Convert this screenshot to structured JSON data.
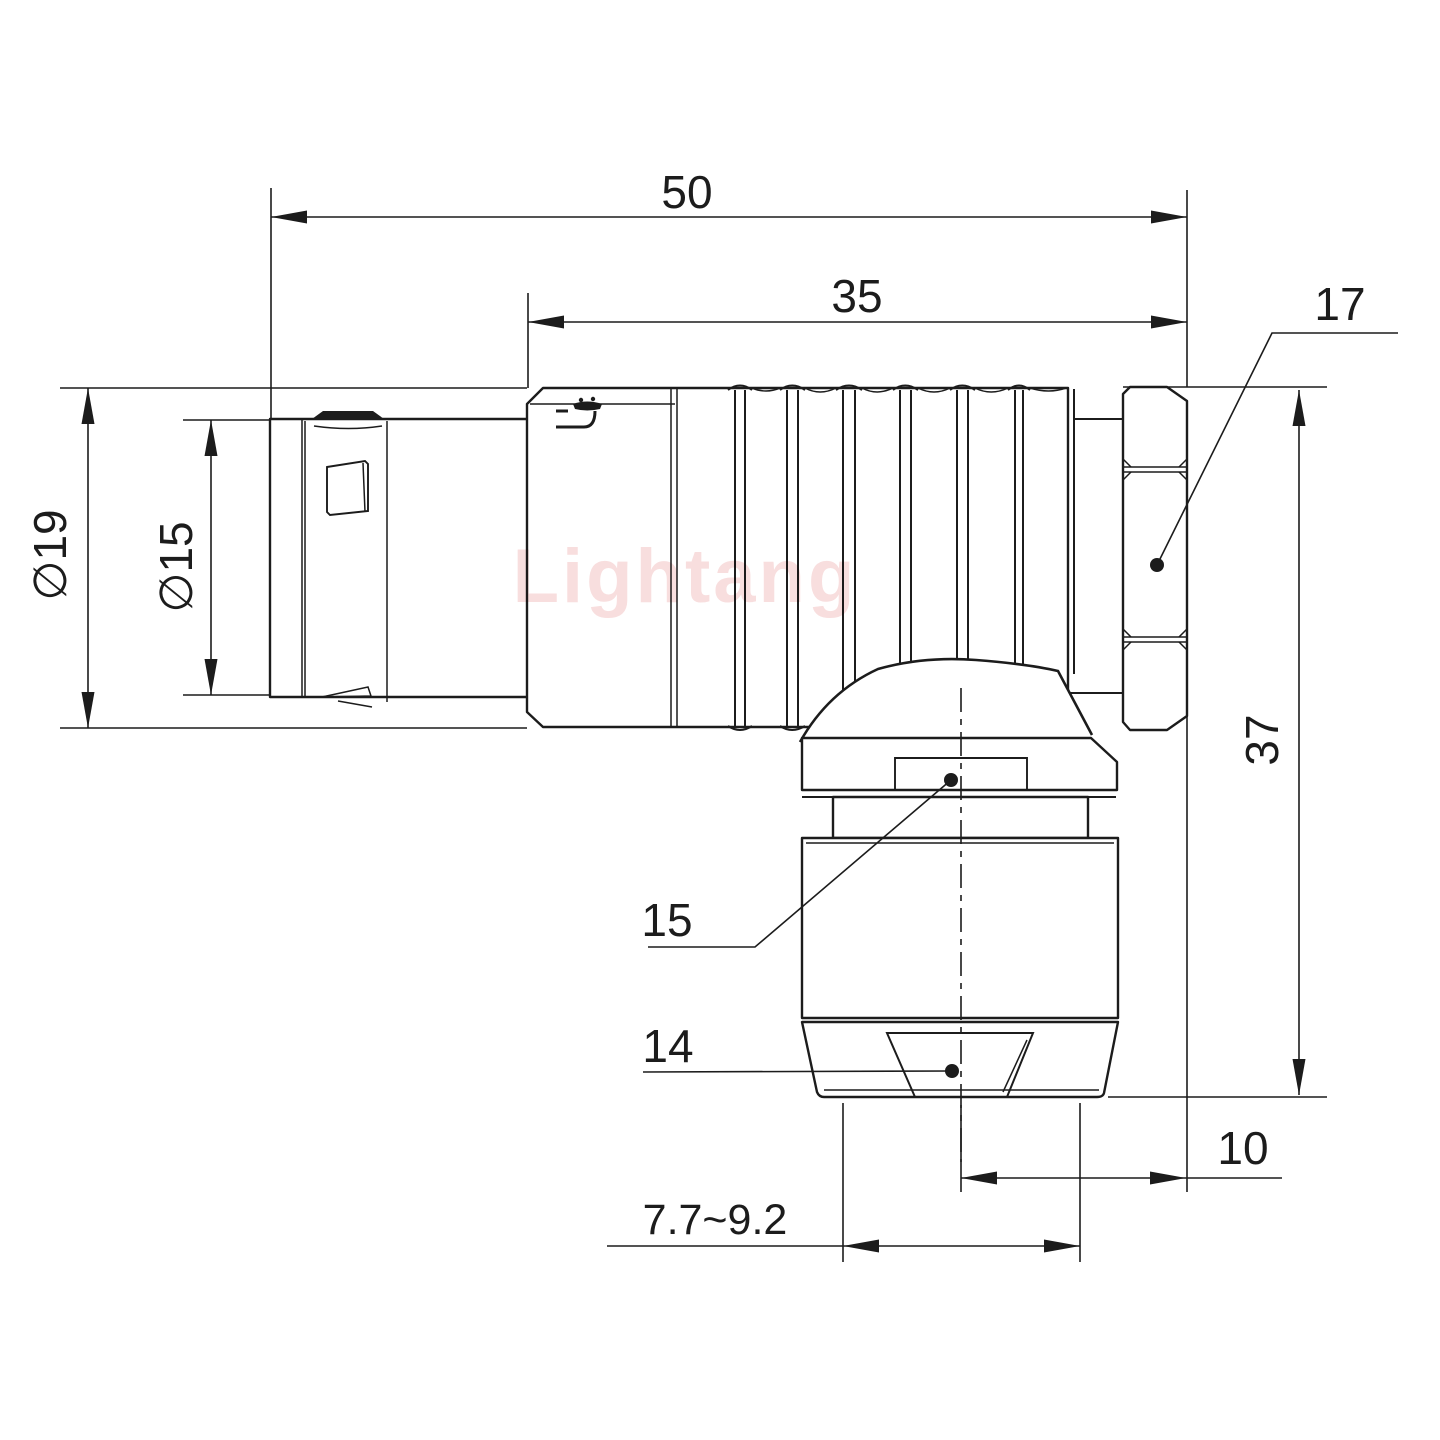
{
  "drawing": {
    "watermark": "Lightang",
    "labels": {
      "overall_length": "50",
      "grip_length": "35",
      "hex_nut_ref": "17",
      "outer_diameter": "∅19",
      "mating_diameter": "∅15",
      "height": "37",
      "collar_ref": "15",
      "clamp_ref": "14",
      "axis_offset": "10",
      "cable_range": "7.7~9.2",
      "cable_caption": "Cable"
    },
    "colors": {
      "line": "#1c1c1c",
      "watermark": "#f2c2c2",
      "background": "#ffffff"
    }
  }
}
